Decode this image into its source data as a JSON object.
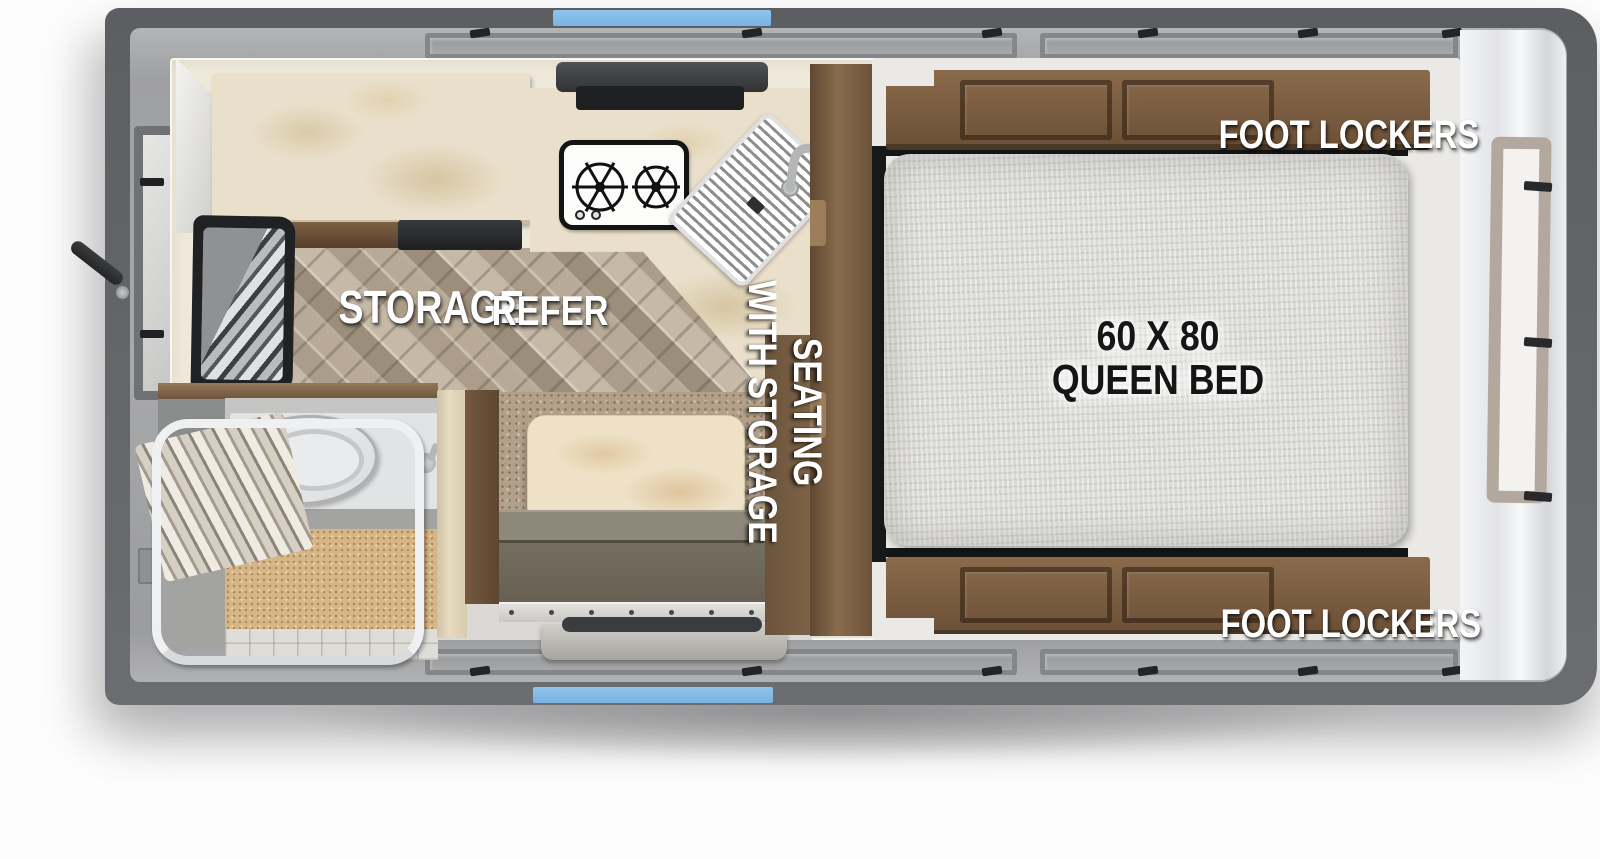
{
  "floorplan": {
    "labels": {
      "storage": "STORAGE",
      "refer": "REFER",
      "seating_line1": "SEATING",
      "seating_line2": "WITH STORAGE",
      "foot_lockers_top": "FOOT LOCKERS",
      "foot_lockers_bottom": "FOOT LOCKERS",
      "bed_size": "60 X 80",
      "bed_type": "QUEEN BED"
    },
    "colors": {
      "accent_blue": "#82BCE9",
      "shell_gray": "#636568",
      "roof_gray": "#A5A6A8",
      "cabinet_wood": "#7A5D42",
      "counter_marble": "#E9DFCA",
      "floor_wood": "#BDB0A0",
      "dinette_carpet": "#B2A08A",
      "bench_olive": "#6E685B",
      "mattress_white": "#DBDAD6",
      "bath_floor_tan": "#D6B587"
    },
    "fixtures": [
      "two-burner-cooktop",
      "range-hood",
      "kitchen-sink",
      "refrigerator",
      "storage-steps",
      "dinette-table",
      "bench-seat",
      "queen-bed-mattress",
      "foot-lockers",
      "toilet",
      "shower-curtain-rod",
      "wicker-mat",
      "entry-door-step",
      "window-left",
      "window-right",
      "jack-handle"
    ]
  }
}
